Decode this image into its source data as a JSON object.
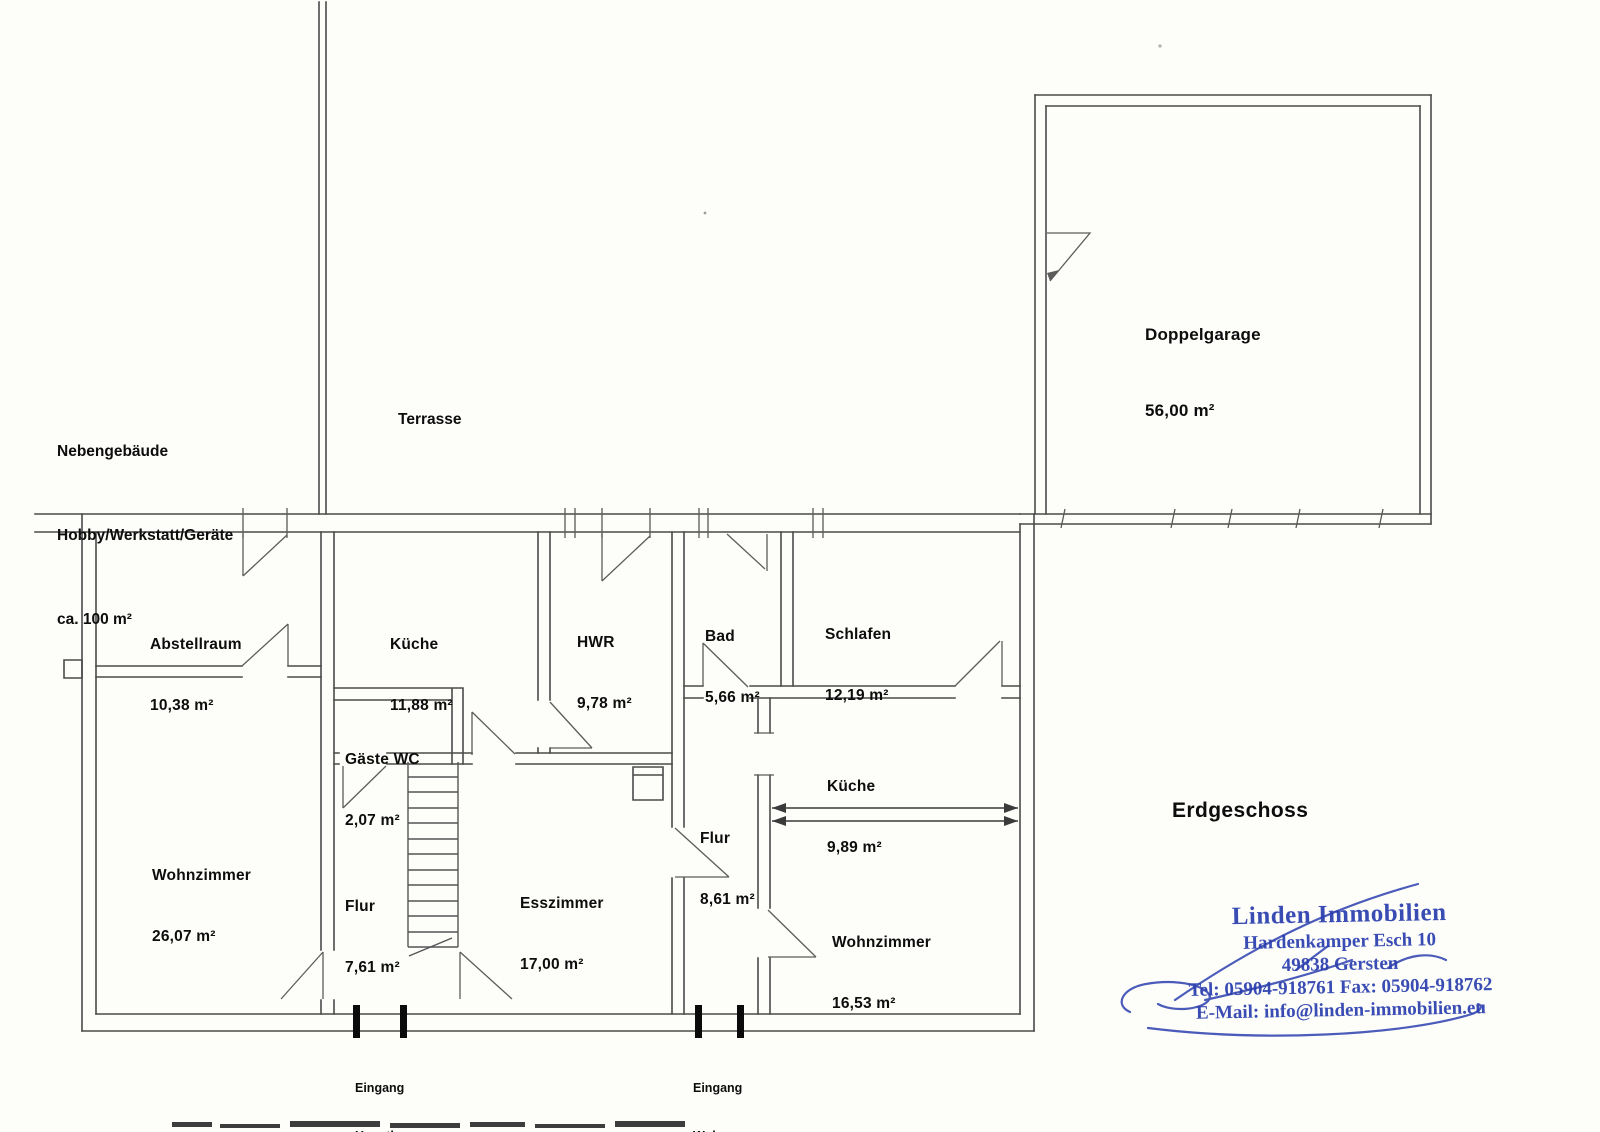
{
  "plan": {
    "floor_title": "Erdgeschoss",
    "annotations": {
      "outbuilding_line1": "Nebengebäude",
      "outbuilding_line2": "Hobby/Werkstatt/Geräte",
      "outbuilding_line3": "ca. 100 m²",
      "terrace": "Terrasse",
      "entrance_main_line1": "Eingang",
      "entrance_main_line2": "Haupthaus",
      "entrance_apartment_line1": "Eingang",
      "entrance_apartment_line2": "Wohnung"
    },
    "rooms": [
      {
        "name": "Doppelgarage",
        "area": "56,00 m²"
      },
      {
        "name": "Abstellraum",
        "area": "10,38 m²"
      },
      {
        "name": "Küche",
        "area": "11,88 m²"
      },
      {
        "name": "HWR",
        "area": "9,78 m²"
      },
      {
        "name": "Bad",
        "area": "5,66 m²"
      },
      {
        "name": "Schlafen",
        "area": "12,19 m²"
      },
      {
        "name": "Gäste WC",
        "area": "2,07 m²"
      },
      {
        "name": "Küche",
        "area": "9,89 m²"
      },
      {
        "name": "Flur",
        "area": "8,61 m²"
      },
      {
        "name": "Wohnzimmer",
        "area": "26,07 m²"
      },
      {
        "name": "Flur",
        "area": "7,61 m²"
      },
      {
        "name": "Esszimmer",
        "area": "17,00 m²"
      },
      {
        "name": "Wohnzimmer",
        "area": "16,53 m²"
      }
    ],
    "stamp": {
      "company": "Linden Immobilien",
      "street": "Hardenkamper Esch 10",
      "city": "49838 Gersten",
      "phone": "Tel: 05904-918761   Fax: 05904-918762",
      "email": "E-Mail: info@linden-immobilien.eu",
      "ink_color": "#2b3fae"
    },
    "colors": {
      "wall_line": "#4b4b4b",
      "door_line": "#5c5c5c",
      "text": "#0d0d0d",
      "paper": "#fdfdfa"
    }
  }
}
